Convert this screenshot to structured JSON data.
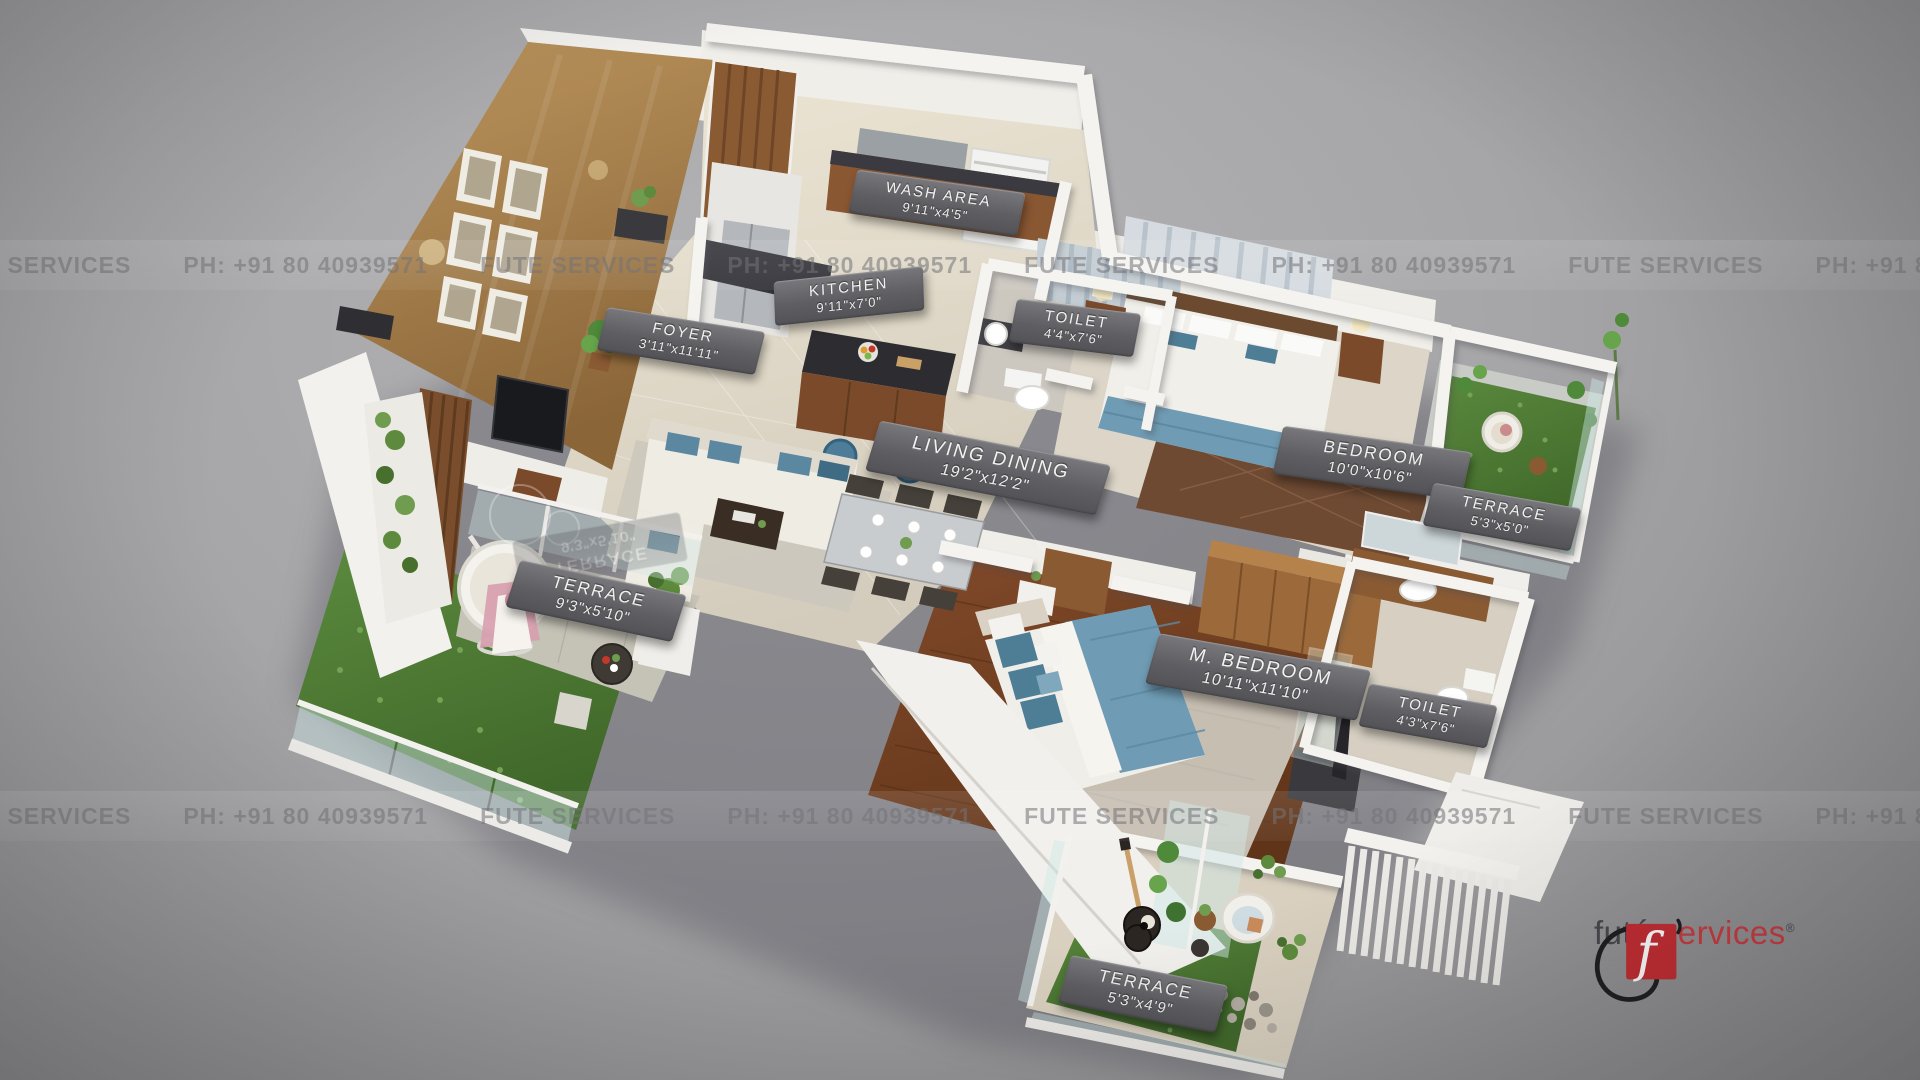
{
  "scene": {
    "description": "3D isometric floor plan render of a 2BHK apartment on gray backdrop",
    "colors": {
      "background": "#9c9c9e",
      "label_plate": "#5e5e63",
      "accent_red": "#c22b30",
      "grass_green": "#4c7a33",
      "wood_brown": "#8a5a33",
      "bedding_blue": "#6f9cb4",
      "wall_white": "#f2f1ee"
    }
  },
  "watermark": {
    "tokens": [
      "FUTE SERVICES",
      "PH: +91 80 40939571"
    ]
  },
  "rooms": [
    {
      "name": "WASH AREA",
      "dims": "9'11\"x4'5\""
    },
    {
      "name": "KITCHEN",
      "dims": "9'11\"x7'0\""
    },
    {
      "name": "FOYER",
      "dims": "3'11\"x11'11\""
    },
    {
      "name": "TOILET",
      "dims": "4'4\"x7'6\""
    },
    {
      "name": "BEDROOM",
      "dims": "10'0\"x10'6\""
    },
    {
      "name": "TERRACE",
      "dims": "5'3\"x5'0\""
    },
    {
      "name": "LIVING DINING",
      "dims": "19'2\"x12'2\""
    },
    {
      "name": "TERRACE",
      "dims": "9'3\"x5'10\""
    },
    {
      "name": "M. BEDROOM",
      "dims": "10'11\"x11'10\""
    },
    {
      "name": "TOILET",
      "dims": "4'3\"x7'6\""
    },
    {
      "name": "TERRACE",
      "dims": "5'3\"x4'9\""
    }
  ],
  "logo": {
    "brand_first": "futé",
    "brand_second": "services",
    "registered": "®",
    "tagline": "Futuristic Unique Trendy Exceptional"
  }
}
